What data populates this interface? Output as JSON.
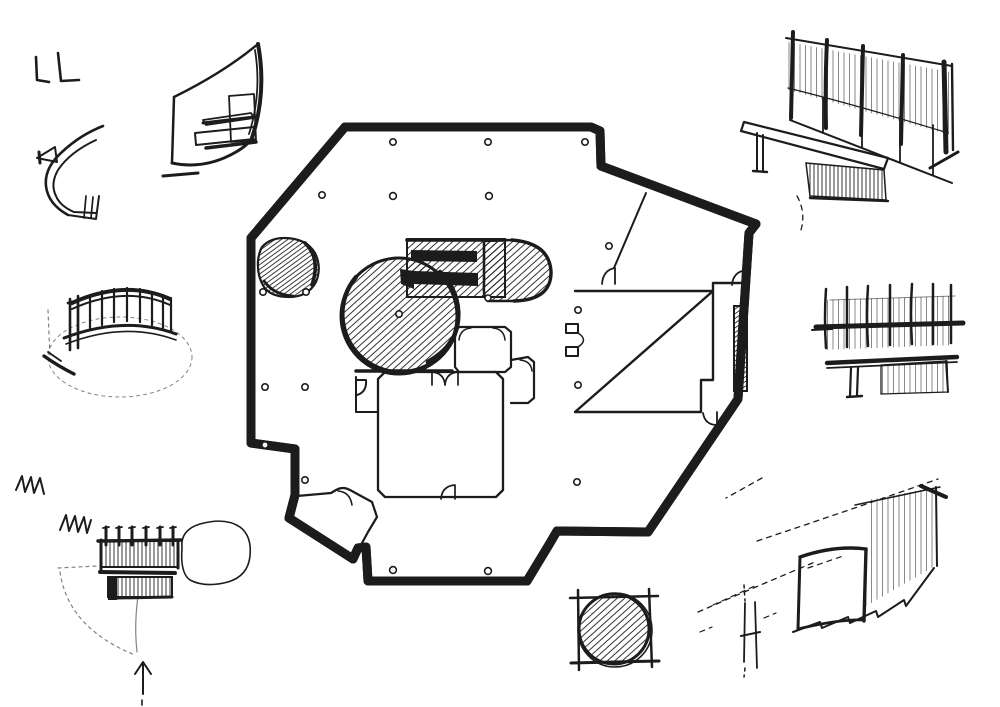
{
  "colors": {
    "ink": "#1c1c1c",
    "paper": "#ffffff"
  },
  "drawing": {
    "subject": "hand-drawn architectural concept sheet: central floor plan surrounded by perspective detail studies",
    "floor_plan": {
      "label": "irregular heptagonal chapel floor plan with double wall",
      "features": {
        "hatched_large_circle": "large hatched round volume left of center",
        "hatched_corner_blob": "small hatched round volume in upper-left wall corner",
        "hatched_band_with_bars": "hatched rectangular band with two solid black bars",
        "hatched_d_volume": "hatched D-shaped volume right of band",
        "central_room": "square room with chamfered corners and double doors",
        "small_rooms": "two small chamfered rooms above central room",
        "right_room": "large rectangular room with hatched wall strip",
        "entry_vestibule": "angled entry vestibule at lower left",
        "column_dots": 18
      }
    },
    "sketches": {
      "l_marks": {
        "label": "two L-shaped pen marks"
      },
      "curved_wall": {
        "label": "curved sail wall perspective study"
      },
      "ribbon": {
        "label": "curved ramp band study"
      },
      "railing": {
        "label": "curved railing on oval base"
      },
      "entry_detail": {
        "label": "entry detail plan with approach arrow and scribbles"
      },
      "square_circle": {
        "label": "hatched circle inscribed in square (column base)"
      },
      "bench_wall": {
        "label": "bench in front of fin wall, perspective"
      },
      "fence_bench": {
        "label": "fence and bench elevation studies"
      },
      "window_wall": {
        "label": "receding wall with curved opening, perspective"
      }
    }
  }
}
